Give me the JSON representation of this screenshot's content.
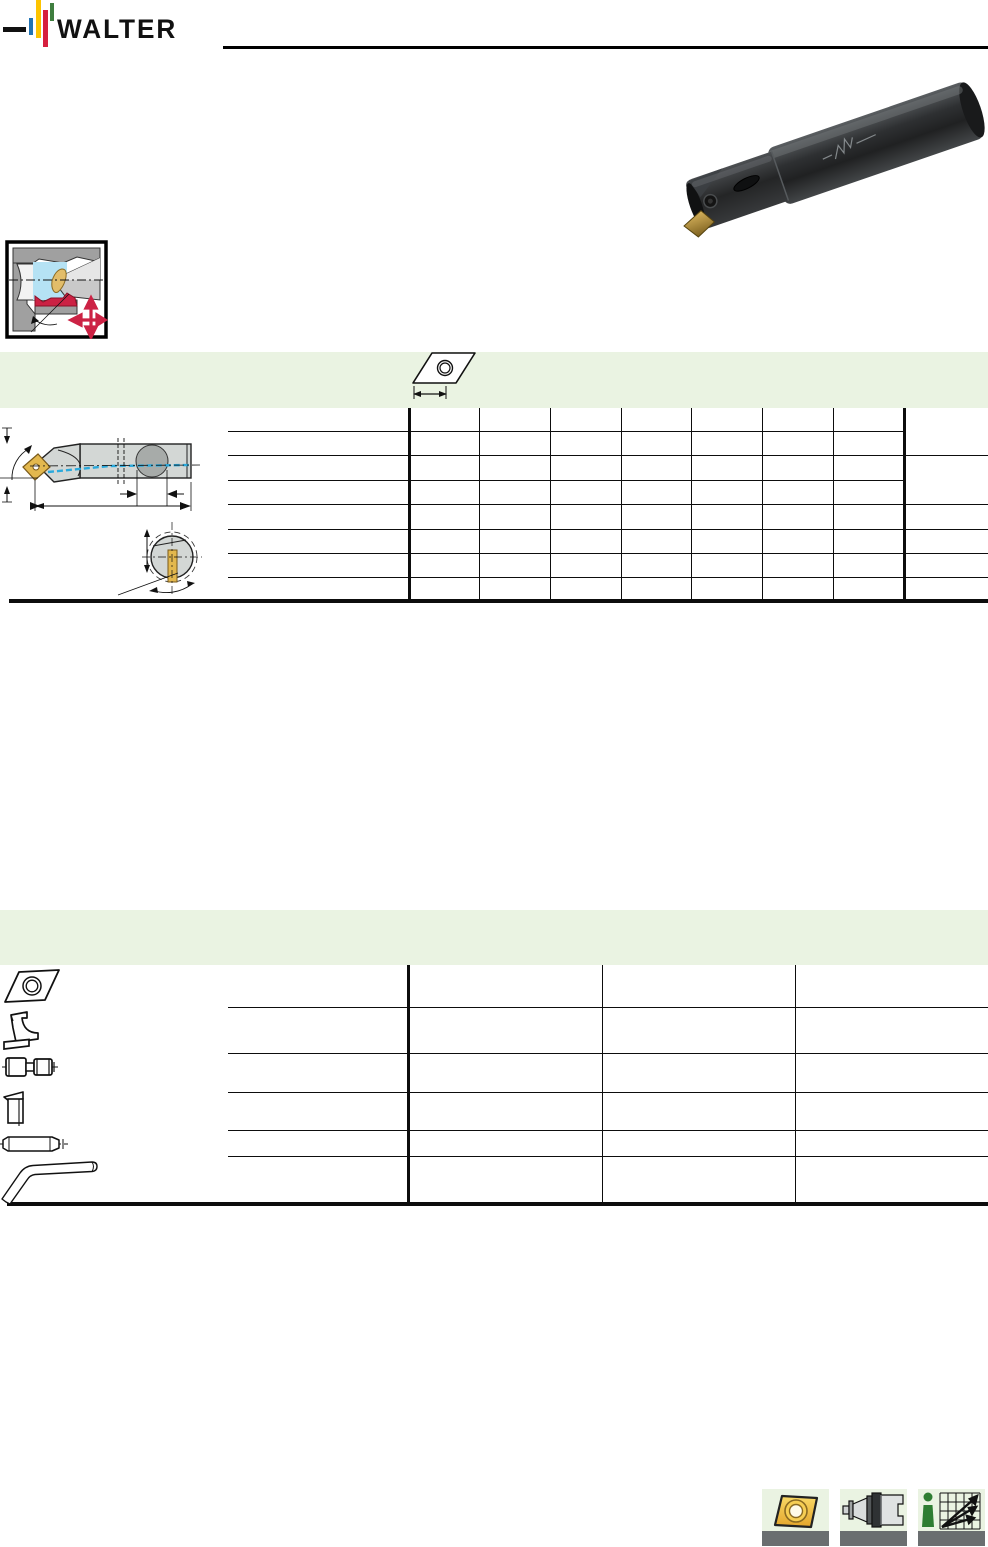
{
  "brand": {
    "logo_text": "WALTER"
  },
  "colors": {
    "brand_blue": "#2173b4",
    "brand_yellow": "#fdc400",
    "brand_red": "#d6203e",
    "brand_green": "#3f7e3f",
    "band_green": "#eaf3e2",
    "insert_gold": "#e3b84e",
    "centerline_blue": "#2aa9dc",
    "accent_red": "#cc2244",
    "drawing_gray": "#d3d7d5",
    "tile_bar_gray": "#6a6e70"
  },
  "icons": {
    "header_logo": "walter-logo",
    "application_pictogram": "internal-turning-pictogram",
    "band1_insert_icon": "insert-top-view-icon",
    "table1_drawing": "boring-bar-dimension-drawing",
    "table2_row_icons": [
      "insert-icon",
      "clamp-icon",
      "clamping-screw-icon",
      "shim-icon",
      "shim-pin-icon",
      "allen-key-icon"
    ],
    "footer_tile_icons": [
      "insert-photo-icon",
      "tool-adapter-icon",
      "info-cutting-data-icon"
    ]
  },
  "tables": {
    "table1": {
      "rows": 8,
      "data_columns": 7,
      "right_note_column": 1,
      "visible_text": ""
    },
    "table2": {
      "rows": 6,
      "data_columns": 3,
      "visible_text": ""
    }
  },
  "photo": {
    "subject": "boring-bar-with-indexable-insert"
  }
}
